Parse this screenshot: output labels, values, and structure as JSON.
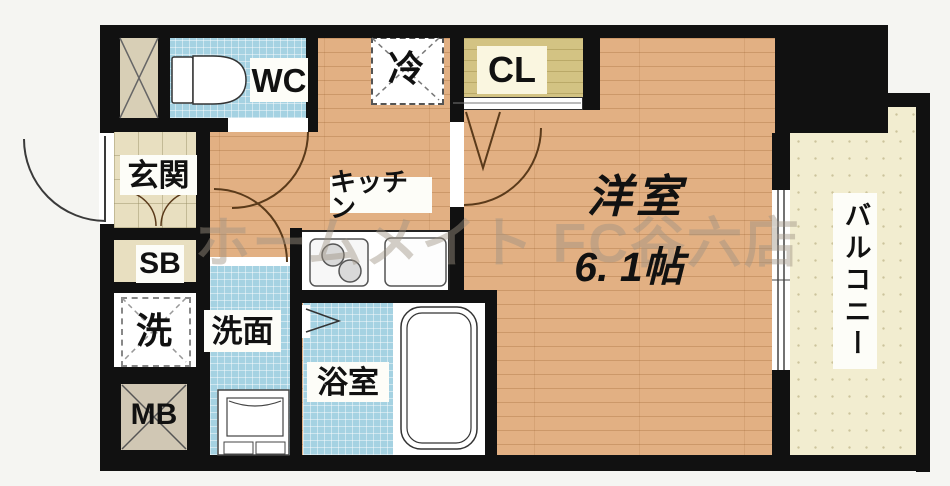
{
  "floorplan": {
    "type": "japanese-apartment-floorplan",
    "watermark": "ホームメイト FC谷六店",
    "labels": {
      "wc": "WC",
      "entrance": "玄関",
      "shoe_box": "SB",
      "washer": "洗",
      "meter_box": "MB",
      "washroom": "洗面",
      "bathroom": "浴室",
      "kitchen": "キッチン",
      "refrigerator": "冷",
      "closet": "CL",
      "main_room_name": "洋室",
      "main_room_size": "6. 1帖",
      "balcony": "バルコニー"
    },
    "rooms": [
      {
        "id": "wc",
        "label": "WC"
      },
      {
        "id": "entrance",
        "label": "玄関"
      },
      {
        "id": "shoe_box",
        "label": "SB"
      },
      {
        "id": "washer_space",
        "label": "洗"
      },
      {
        "id": "meter_box",
        "label": "MB"
      },
      {
        "id": "washroom",
        "label": "洗面"
      },
      {
        "id": "bathroom",
        "label": "浴室"
      },
      {
        "id": "kitchen",
        "label": "キッチン"
      },
      {
        "id": "refrigerator_space",
        "label": "冷"
      },
      {
        "id": "closet",
        "label": "CL"
      },
      {
        "id": "western_room",
        "label": "洋室",
        "size": "6. 1帖"
      },
      {
        "id": "balcony",
        "label": "バルコニー"
      }
    ],
    "colors": {
      "wall": "#111111",
      "wood": "#e2b083",
      "tile": "#a5d2e2",
      "etile": "#e8dfc0",
      "cl": "#d3c383",
      "balc": "#f2edd0",
      "box": "#d8cfb6",
      "mbfill": "#d0c7b4",
      "label": "#fdfdf8"
    }
  }
}
